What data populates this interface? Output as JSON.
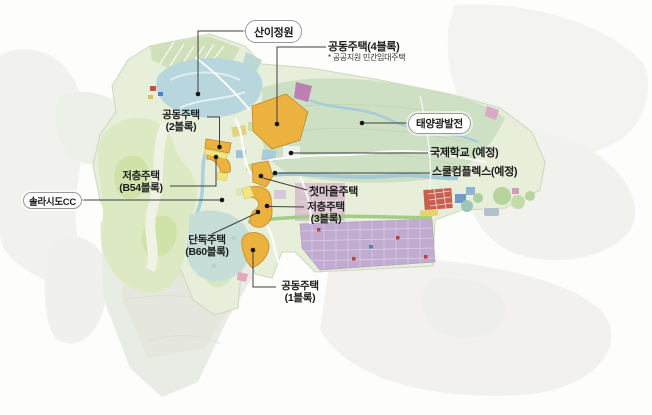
{
  "map": {
    "title": "solaseado-development-land-use-map",
    "colors": {
      "background": "#fdfdfc",
      "housing_block_orange": "#ecb23f",
      "housing_block_border": "#bf8a22",
      "yellow_strip": "#f2e582",
      "garden_blue": "#b7d6de",
      "field_green": "#cde0c3",
      "golf_green": "#dde9c3",
      "solar_grid_purple": "#c2abd0",
      "marsh_gray": "#e9ebe5",
      "water_blue": "#a5cad6",
      "leader_line": "#3f3f3f",
      "marker_dot": "#141414",
      "boxed_label_border": "#9a9a9a"
    },
    "labels": {
      "sanigarden": {
        "text": "산이정원"
      },
      "apt4": {
        "title": "공동주택(4블록)",
        "note": "* 공공지원 민간임대주택"
      },
      "apt2": {
        "line1": "공동주택",
        "line2": "(2블록)"
      },
      "b54": {
        "line1": "저층주택",
        "line2": "(B54블록)"
      },
      "solasido_cc": {
        "text": "솔라시도CC"
      },
      "b60": {
        "line1": "단독주택",
        "line2": "(B60블록)"
      },
      "apt1": {
        "line1": "공동주택",
        "line2": "(1블록)"
      },
      "first_village": {
        "text": "첫마을주택"
      },
      "low3": {
        "line1": "저층주택",
        "line2": "(3블록)"
      },
      "intl_school": {
        "text": "국제학교 (예정)"
      },
      "school_complex": {
        "text": "스쿨컴플렉스(예정)"
      },
      "solar": {
        "text": "태양광발전"
      }
    }
  }
}
